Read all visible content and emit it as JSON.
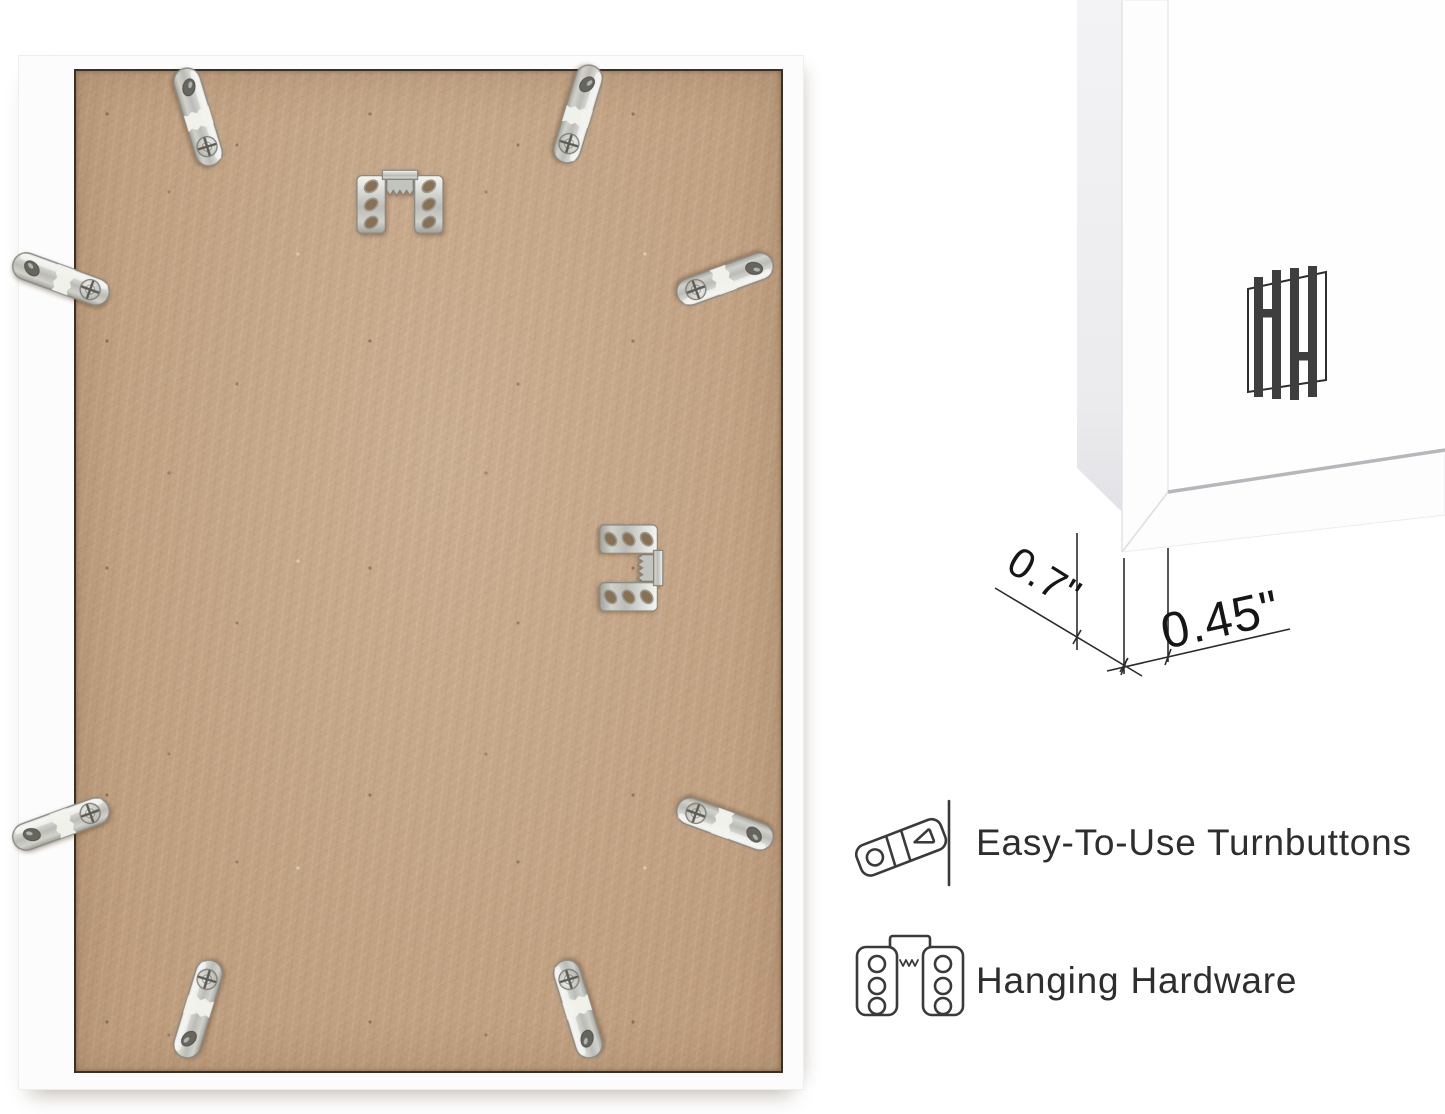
{
  "measurements": {
    "frame_depth": "0.7\"",
    "frame_face_width": "0.45\""
  },
  "features": [
    {
      "icon": "turnbutton-outline-icon",
      "label": "Easy-To-Use Turnbuttons"
    },
    {
      "icon": "hanging-hardware-outline-icon",
      "label": "Hanging Hardware"
    }
  ],
  "logo": {
    "monogram": "HH"
  },
  "hardware": {
    "turnbuttons": 8,
    "sawtooth_hangers": 2
  },
  "colors": {
    "board_kraft": "#c5a585",
    "frame_white": "#fcfcfd",
    "metal_silver": "#cdcdc8",
    "annotation_ink": "#2c2c2c",
    "logo_ink": "#3e3e3e"
  }
}
